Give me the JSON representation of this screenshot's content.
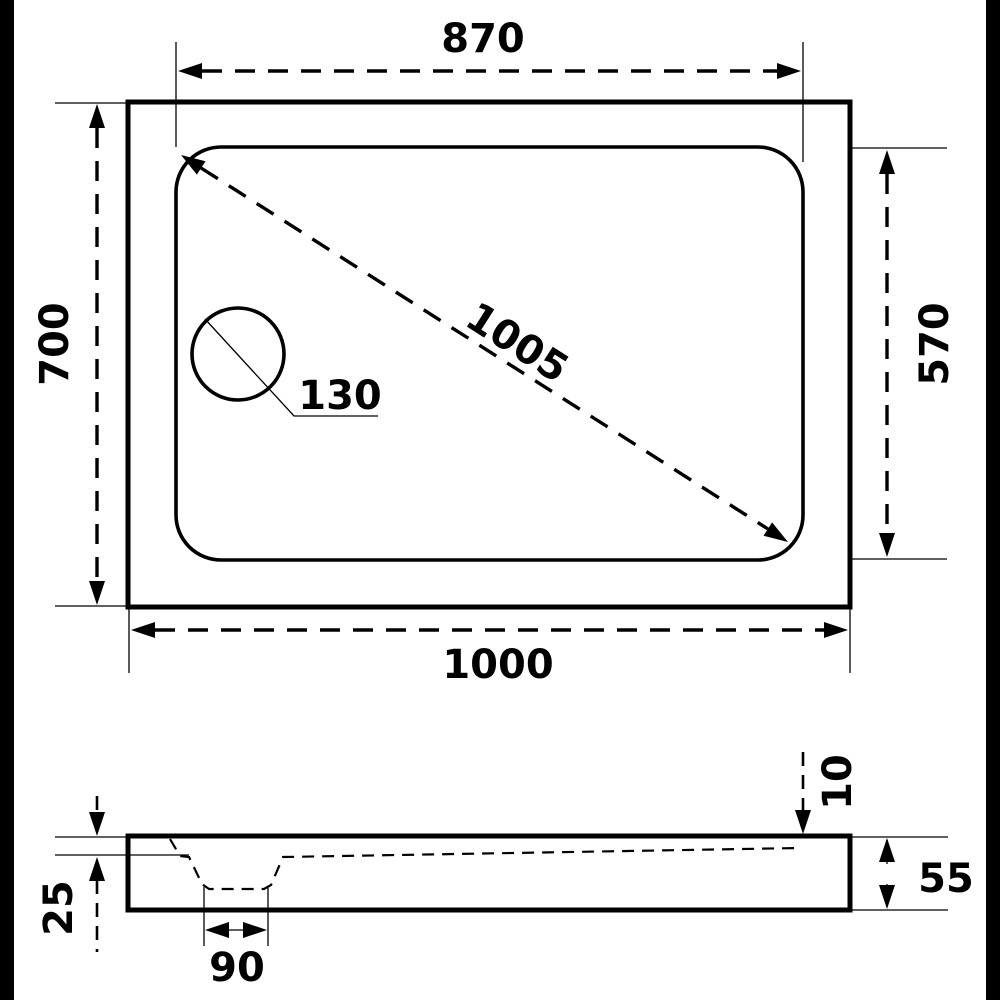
{
  "drawing": {
    "type": "technical-dimension-drawing",
    "subject": "rectangular shower tray, top view and side profile view",
    "colors": {
      "line": "#000000",
      "background": "#ffffff",
      "letterbox": "#000000"
    },
    "top_view": {
      "dims": {
        "inner_width": "870",
        "outer_height": "700",
        "inner_height": "570",
        "outer_width": "1000",
        "diagonal": "1005",
        "drain_diameter": "130"
      }
    },
    "side_view": {
      "dims": {
        "edge_depth": "10",
        "total_height": "55",
        "basin_depth": "25",
        "drain_recess_width": "90"
      }
    }
  }
}
